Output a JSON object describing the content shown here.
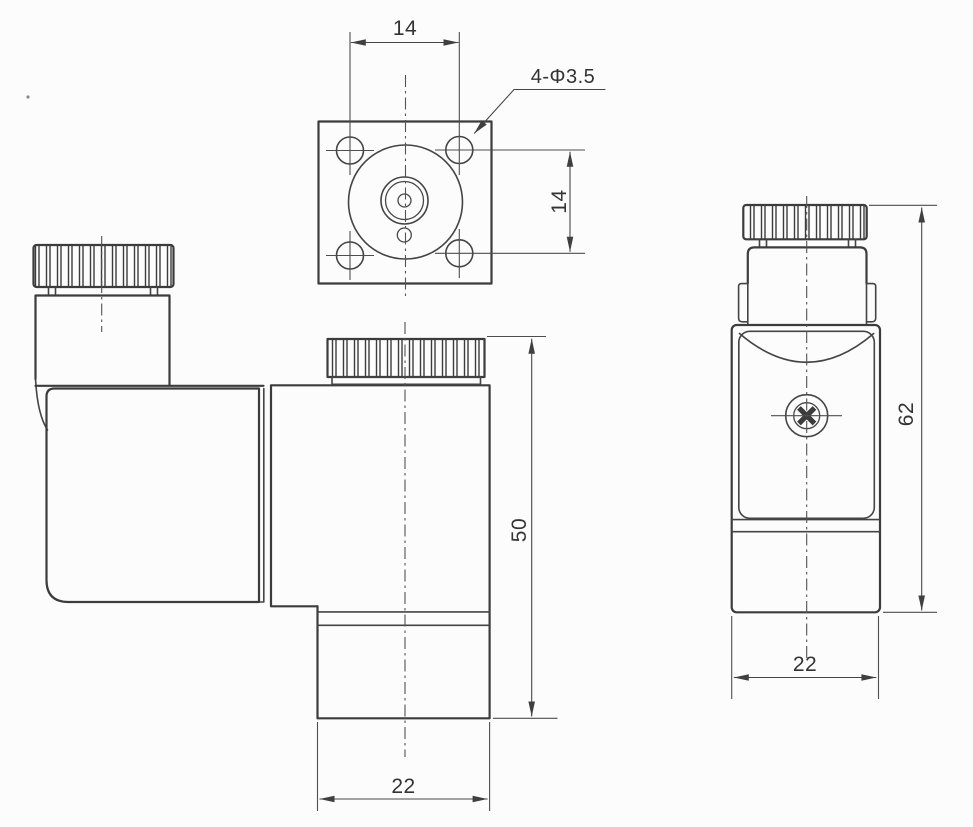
{
  "meta": {
    "description": "Solenoid coil dimensional drawing with three orthographic views"
  },
  "colors": {
    "background": "#fcfcfc",
    "outline": "#3c3c3c",
    "thin_line": "#4e4e4e",
    "text": "#333333"
  },
  "top_view": {
    "dim_hole_spacing_horizontal": "14",
    "dim_hole_spacing_vertical": "14",
    "hole_callout": "4-Φ3.5"
  },
  "front_view": {
    "dim_height": "50",
    "dim_width": "22"
  },
  "side_view": {
    "dim_height": "62",
    "dim_width": "22"
  }
}
